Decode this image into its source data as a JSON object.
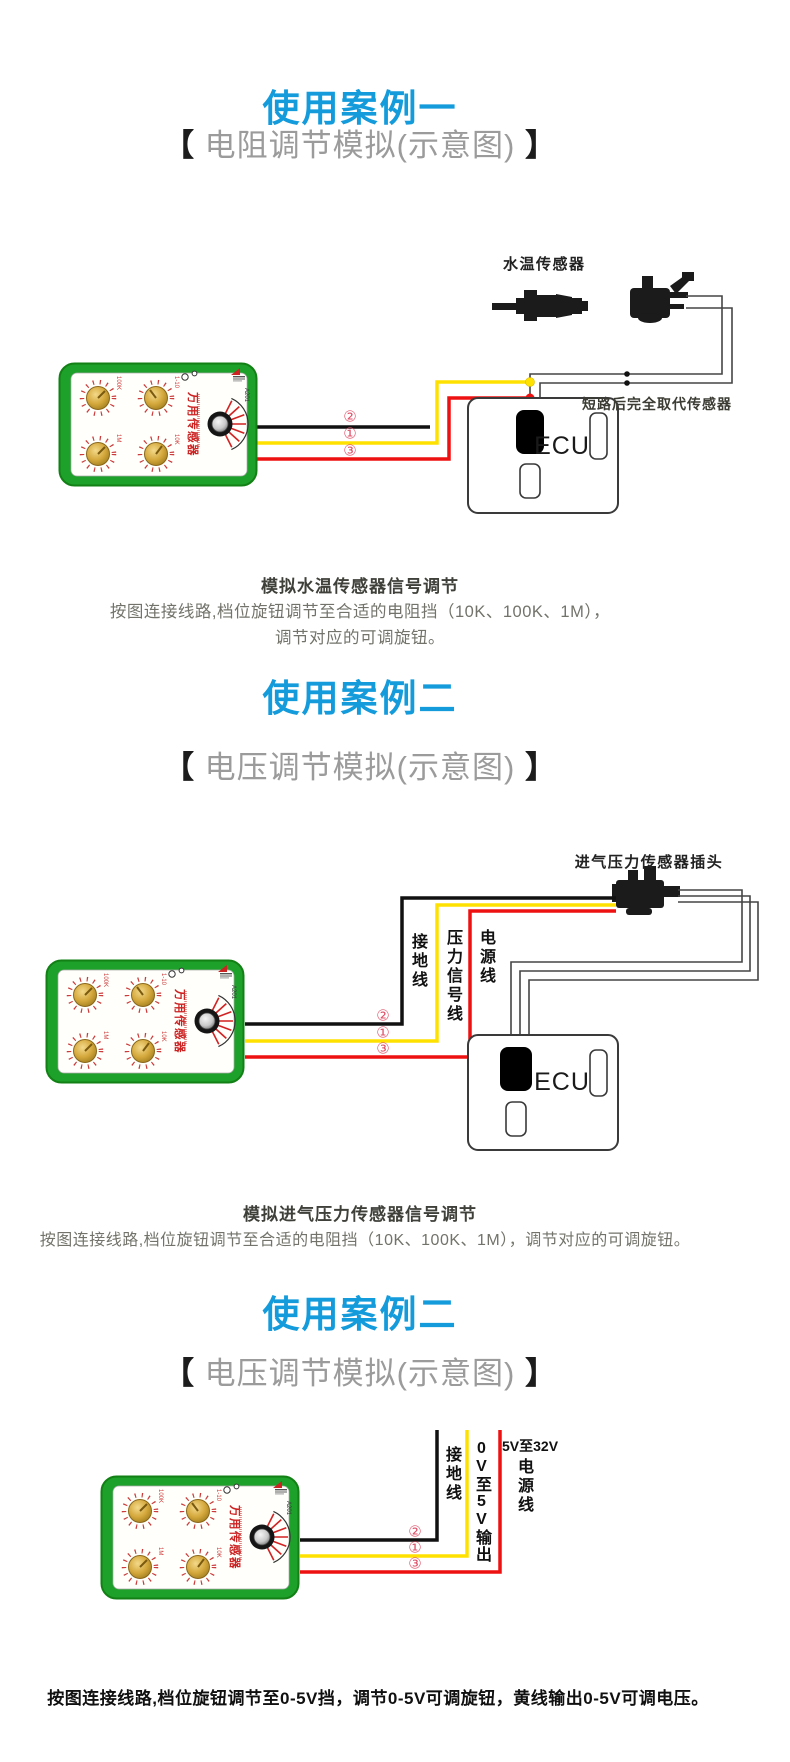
{
  "page": {
    "background": "#ffffff"
  },
  "colors": {
    "title_blue": "#149bdb",
    "subtitle_gray": "#9b9b9b",
    "wire_black": "#111111",
    "wire_yellow": "#ffe100",
    "wire_red": "#ee1111",
    "circuit_gray": "#454545",
    "device_green": "#1ea12a",
    "badge_red": "#e0526a",
    "body_text": "#73736b",
    "caption_text": "#40403a"
  },
  "device": {
    "name_label": "万用传感器",
    "model_label": "A201",
    "knob_labels": [
      "100K",
      "1-10",
      "1M",
      "10K"
    ]
  },
  "section1": {
    "title": "使用案例一",
    "subtitle_left": "【",
    "subtitle_text": " 电阻调节模拟(示意图) ",
    "subtitle_right": "】",
    "sensor_label": "水温传感器",
    "bypass_note": "短路后完全取代传感器",
    "ecu_label": "ECU",
    "badges": [
      "②",
      "①",
      "③"
    ],
    "caption": "模拟水温传感器信号调节",
    "body_line1": "按图连接线路,档位旋钮调节至合适的电阻挡（10K、100K、1M），",
    "body_line2": "调节对应的可调旋钮。"
  },
  "section2": {
    "title": "使用案例二",
    "subtitle_left": "【",
    "subtitle_text": " 电压调节模拟(示意图) ",
    "subtitle_right": "】",
    "plug_label": "进气压力传感器插头",
    "label_ground": "接地线",
    "label_signal": "压力信号线",
    "label_power": "电源线",
    "ecu_label": "ECU",
    "badges": [
      "②",
      "①",
      "③"
    ],
    "caption": "模拟进气压力传感器信号调节",
    "body": "按图连接线路,档位旋钮调节至合适的电阻挡（10K、100K、1M），调节对应的可调旋钮。"
  },
  "section3": {
    "title": "使用案例二",
    "subtitle_left": "【",
    "subtitle_text": " 电压调节模拟(示意图) ",
    "subtitle_right": "】",
    "label_ground": "接地线",
    "label_output": "0V至5V输出",
    "label_power_range": "5V至32V",
    "label_power": "电源线",
    "badges": [
      "②",
      "①",
      "③"
    ],
    "footer": "按图连接线路,档位旋钮调节至0-5V挡，调节0-5V可调旋钮，黄线输出0-5V可调电压。"
  }
}
